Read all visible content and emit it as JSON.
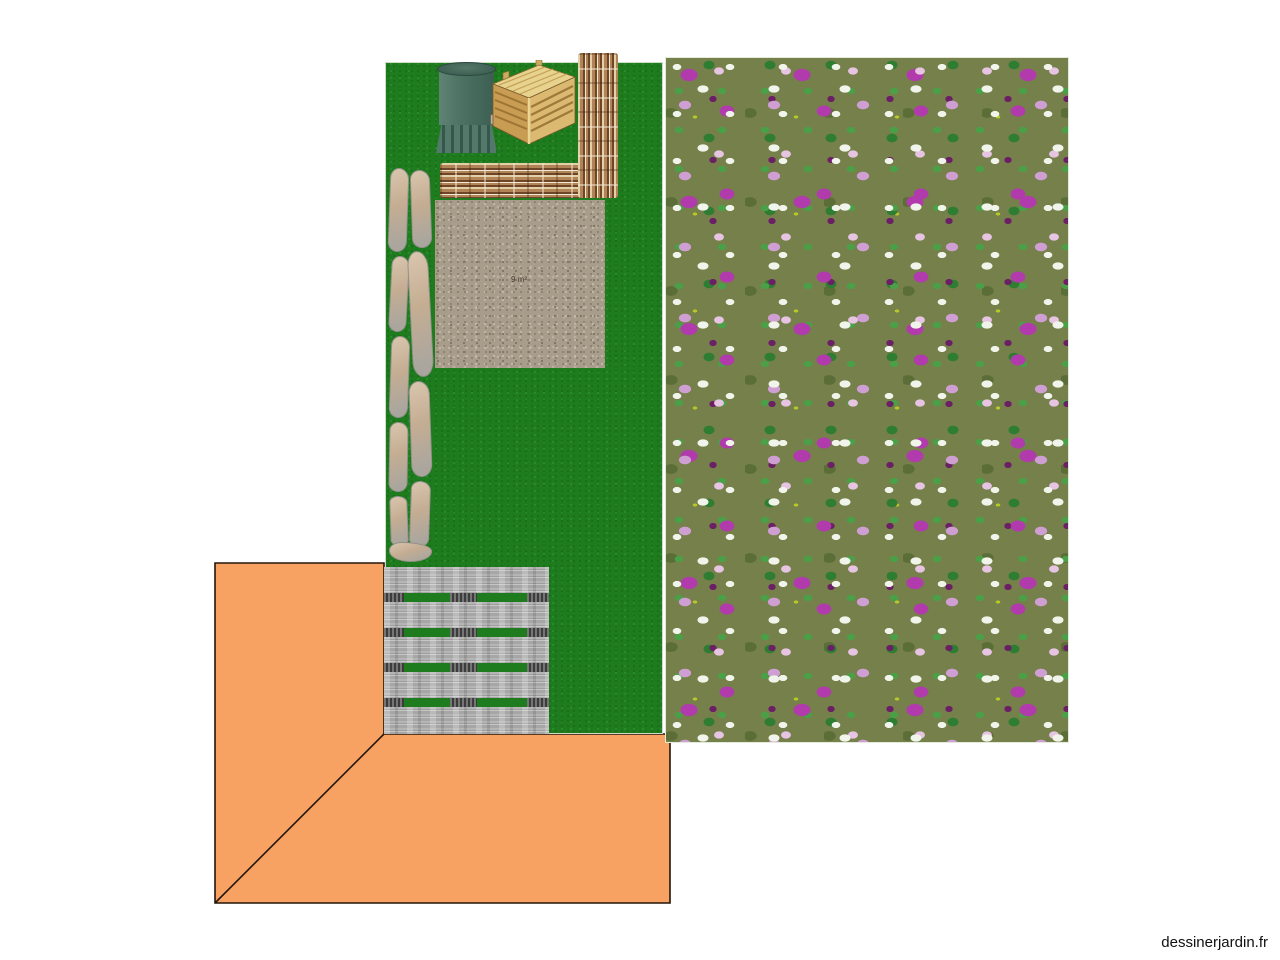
{
  "watermark": "dessinerjardin.fr",
  "plan": {
    "gravel_label": "9 m²",
    "objects": [
      {
        "id": "lawn"
      },
      {
        "id": "flower-bed"
      },
      {
        "id": "gravel-area"
      },
      {
        "id": "stone-path"
      },
      {
        "id": "wicker-fence-horizontal"
      },
      {
        "id": "wicker-fence-vertical"
      },
      {
        "id": "water-barrel"
      },
      {
        "id": "compost-bin"
      },
      {
        "id": "wood-deck"
      },
      {
        "id": "house-terrace"
      }
    ]
  },
  "colors": {
    "lawn-green": "#1e7b1e",
    "lawn-dark": "#176d17",
    "lawn-light": "#2b8f2b",
    "flower-olive": "#75804a",
    "flower-olive2": "#5c6e38",
    "flower-magenta": "#b13bad",
    "flower-plum": "#6b1f64",
    "flower-lilac": "#cf9ed3",
    "flower-pink": "#e6c4e2",
    "flower-white": "#f1f4ea",
    "flower-green": "#4aa047",
    "flower-green2": "#2e7d32",
    "flower-yellow": "#b9c727",
    "gravel-base": "#a89c8b",
    "gravel-dark": "#877b6a",
    "gravel-light": "#c9bfae",
    "stone-fill": "#cdb79e",
    "stone-edge": "#93908a",
    "deck-gray": "#a6a6a6",
    "terrace-orange": "#f7a263",
    "outline-dark": "#231508",
    "barrel-green": "#4d7263",
    "barrel-dark": "#35584c",
    "wood-light": "#e7d28e",
    "wood-mid": "#dcb970",
    "wood-face": "#c89c52",
    "wood-dark": "#8a6a34",
    "wicker-light": "#e3cfa8",
    "wicker-mid": "#b08457",
    "wicker-dark": "#6e4526",
    "watermark-text": "#111111"
  }
}
